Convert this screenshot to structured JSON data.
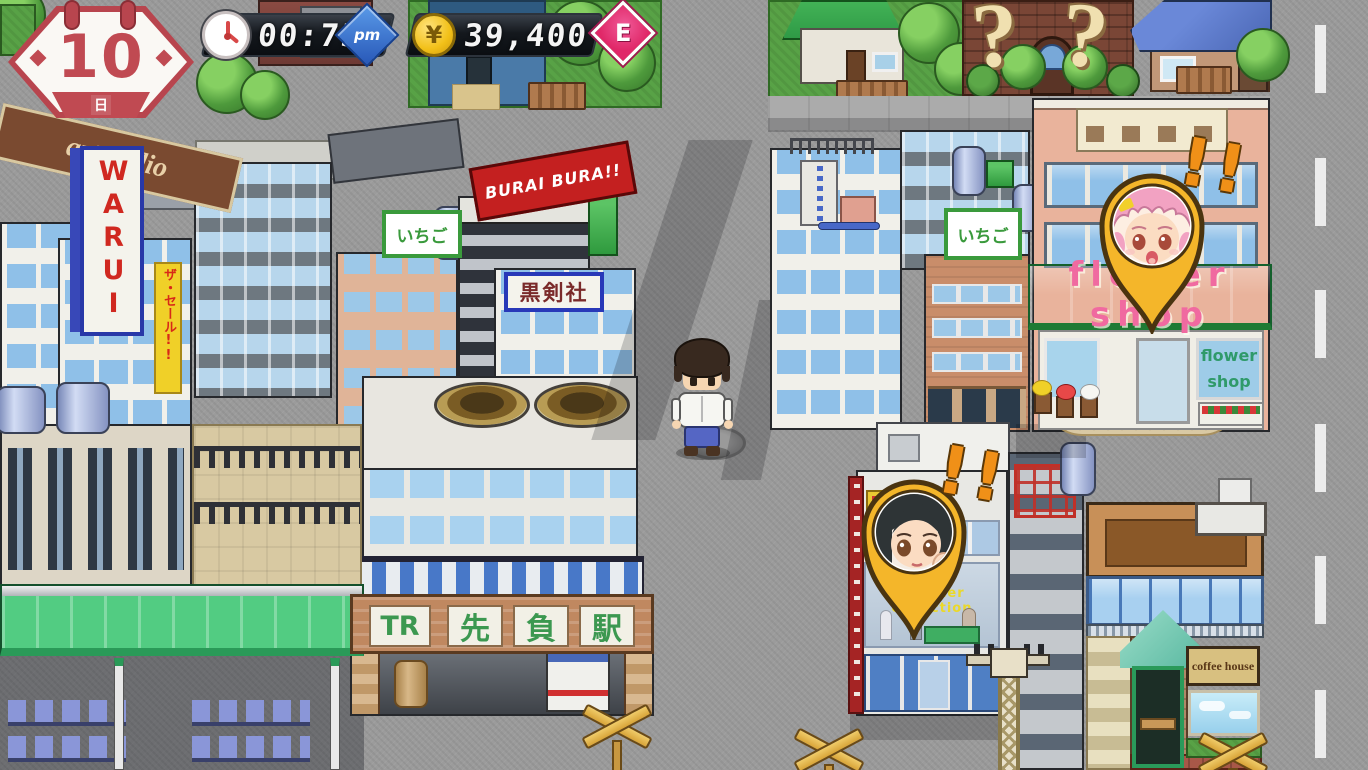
{
  "hud": {
    "calendar": {
      "day": "10",
      "weekday": "日"
    },
    "clock": {
      "time": "00:75",
      "meridiem": "pm"
    },
    "wallet": {
      "currency": "¥",
      "amount": "39,400"
    },
    "rank": "E",
    "icons": [
      "calendar-badge",
      "clock-icon",
      "coin-icon",
      "rank-diamond"
    ]
  },
  "signs": {
    "artstudio": "artstudio",
    "warui": "WARUI",
    "sale_banner": "ザ・セール!!",
    "ichigo_left": "いちご",
    "ichigo_right": "いちご",
    "burai": "BURAI BURA!!",
    "kensha": "黒剣社",
    "station": {
      "panels": [
        "TR",
        "先",
        "負",
        "駅"
      ]
    },
    "flower_awning": "flower shop",
    "flower_window": {
      "line1": "flower",
      "line2": "shop"
    },
    "summer_collection": "summer collection",
    "coffee_house": "coffee house",
    "question_left": "?",
    "question_right": "?"
  },
  "pins": [
    {
      "id": "flower-shop-girl",
      "alert": "!!"
    },
    {
      "id": "department-store-girl",
      "alert": "!!"
    }
  ],
  "colors": {
    "hud_red": "#c04a52",
    "pm_blue": "#2e62c4",
    "rank_pink": "#e83278",
    "coin_yellow": "#f2c018",
    "pin_gold": "#f4b62a",
    "awning_green": "#46b858",
    "awning_text_pink": "#f06aa0",
    "station_text_green": "#3c9850"
  }
}
